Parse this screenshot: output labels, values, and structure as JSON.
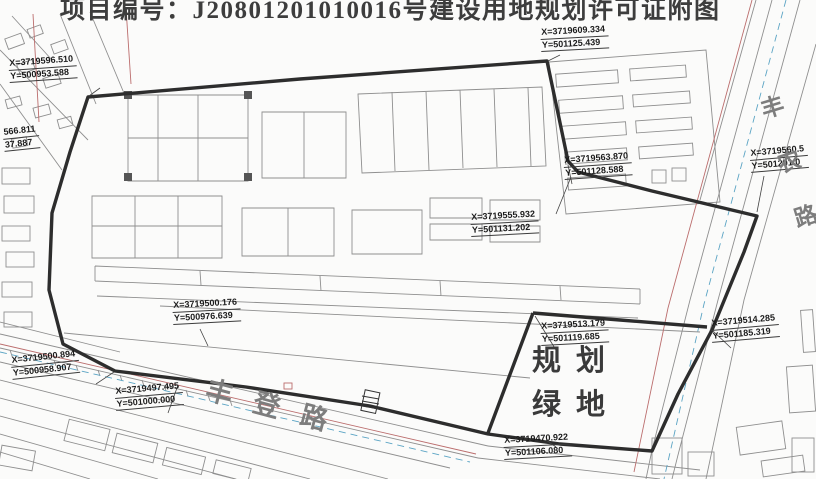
{
  "title": {
    "text": "项目编号：J20801201010016号建设用地规划许可证附图"
  },
  "map": {
    "coordinate_labels": [
      {
        "id": "nw-corner",
        "x": 8,
        "y": 58,
        "rot": -4,
        "lines": [
          "X=3719596.510",
          "Y=500953.588"
        ]
      },
      {
        "id": "north-corner",
        "x": 540,
        "y": 27,
        "rot": -3,
        "lines": [
          "X=3719609.334",
          "Y=501125.439"
        ]
      },
      {
        "id": "west-edge-clipped",
        "x": 2,
        "y": 127,
        "rot": -6,
        "lines": [
          "566.811",
          "37.887"
        ]
      },
      {
        "id": "east-edge-clipped",
        "x": 749,
        "y": 148,
        "rot": -5,
        "lines": [
          "X=3719560.5",
          "Y=501201.0"
        ]
      },
      {
        "id": "mid-east-upper",
        "x": 563,
        "y": 155,
        "rot": -4,
        "lines": [
          "X=3719563.870",
          "Y=501128.588"
        ]
      },
      {
        "id": "mid-center",
        "x": 470,
        "y": 212,
        "rot": -3,
        "lines": [
          "X=3719555.932",
          "Y=501131.202"
        ]
      },
      {
        "id": "mid-west",
        "x": 172,
        "y": 300,
        "rot": -3,
        "lines": [
          "X=3719500.176",
          "Y=500976.639"
        ]
      },
      {
        "id": "green-nw",
        "x": 540,
        "y": 321,
        "rot": -3,
        "lines": [
          "X=3719513.179",
          "Y=501119.685"
        ]
      },
      {
        "id": "green-ne",
        "x": 710,
        "y": 318,
        "rot": -5,
        "lines": [
          "X=3719514.285",
          "Y=501185.319"
        ]
      },
      {
        "id": "sw-corner",
        "x": 10,
        "y": 355,
        "rot": -6,
        "lines": [
          "X=3719500.894",
          "Y=500958.907"
        ]
      },
      {
        "id": "road-point",
        "x": 114,
        "y": 386,
        "rot": -5,
        "lines": [
          "X=3719497.495",
          "Y=501000.000"
        ]
      },
      {
        "id": "south-point",
        "x": 503,
        "y": 435,
        "rot": -3,
        "lines": [
          "X=3719470.922",
          "Y=501106.080"
        ]
      }
    ],
    "road_labels": [
      {
        "id": "fengdeng",
        "text": "丰登路"
      },
      {
        "id": "fengnong",
        "text": "丰农路"
      }
    ],
    "zone_label": {
      "line1": "规划",
      "line2": "绿地"
    }
  },
  "colors": {
    "boundary": "#2d2d2d",
    "parcel_lines": "#8f8f8f",
    "survey_red": "#bb6d6d",
    "utility_blue": "#5ba4c4",
    "paper": "#fbfbfa"
  }
}
